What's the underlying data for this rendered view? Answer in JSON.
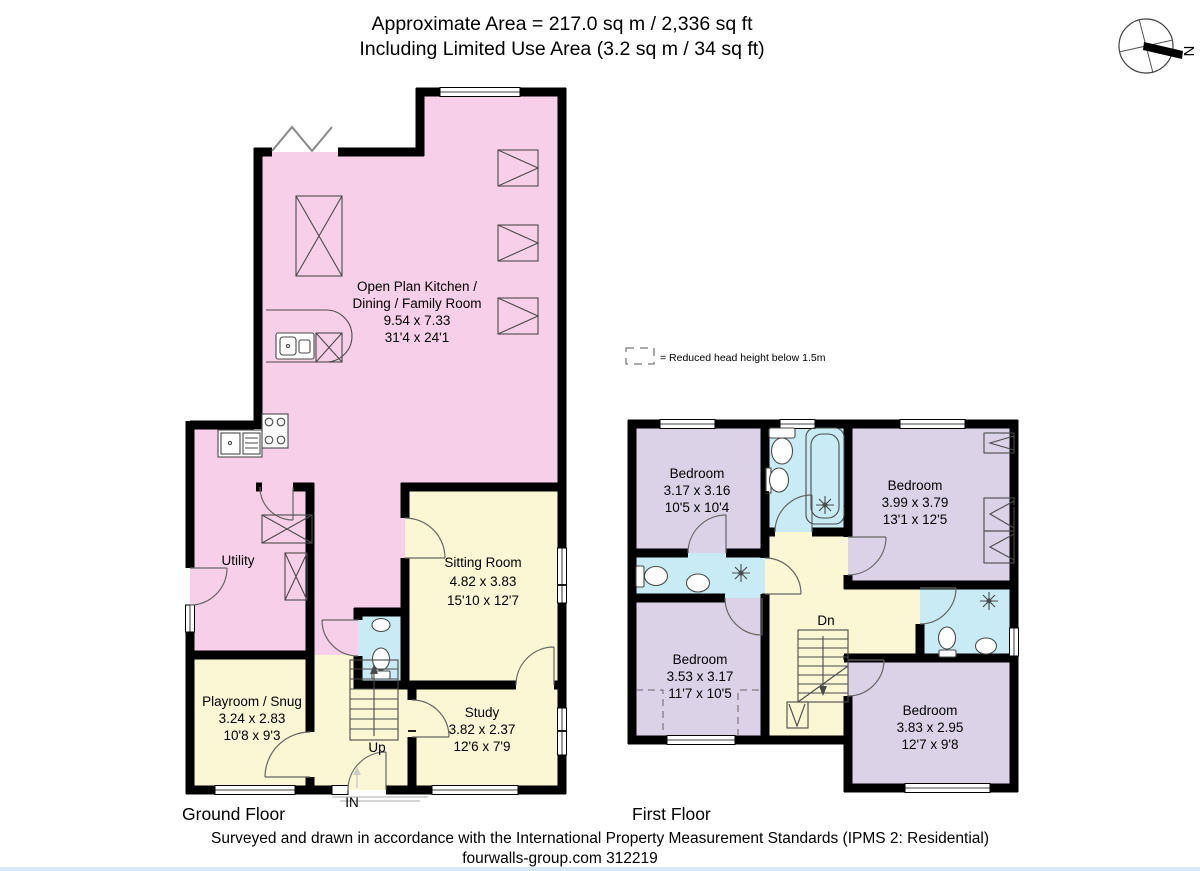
{
  "header": {
    "line1": "Approximate Area = 217.0 sq m / 2,336 sq ft",
    "line2": "Including Limited Use Area (3.2 sq m / 34 sq ft)"
  },
  "compass": {
    "label": "N"
  },
  "legend": {
    "label": "= Reduced head height below 1.5m"
  },
  "ground": {
    "title": "Ground Floor",
    "stairs_label": "Up",
    "entrance_label": "IN",
    "rooms": {
      "kitchen": {
        "line1": "Open Plan Kitchen /",
        "line2": "Dining / Family Room",
        "metric": "9.54 x 7.33",
        "imperial": "31'4 x 24'1"
      },
      "utility": {
        "name": "Utility"
      },
      "sitting": {
        "name": "Sitting Room",
        "metric": "4.82 x 3.83",
        "imperial": "15'10 x 12'7"
      },
      "playroom": {
        "name": "Playroom / Snug",
        "metric": "3.24 x 2.83",
        "imperial": "10'8 x 9'3"
      },
      "study": {
        "name": "Study",
        "metric": "3.82 x 2.37",
        "imperial": "12'6 x 7'9"
      }
    }
  },
  "first": {
    "title": "First Floor",
    "stairs_label": "Dn",
    "rooms": {
      "bedroom1": {
        "name": "Bedroom",
        "metric": "3.17 x 3.16",
        "imperial": "10'5 x 10'4"
      },
      "bedroom2": {
        "name": "Bedroom",
        "metric": "3.99 x 3.79",
        "imperial": "13'1 x 12'5"
      },
      "bedroom3": {
        "name": "Bedroom",
        "metric": "3.53 x 3.17",
        "imperial": "11'7 x 10'5"
      },
      "bedroom4": {
        "name": "Bedroom",
        "metric": "3.83 x 2.95",
        "imperial": "12'7 x 9'8"
      }
    }
  },
  "footer": {
    "line1": "Surveyed and drawn in accordance with the International Property Measurement Standards (IPMS 2: Residential)",
    "line2": "fourwalls-group.com 312219"
  },
  "colors": {
    "pink": "#f8cfe9",
    "yellow": "#fbf6d3",
    "purple": "#dbd2e8",
    "cyan": "#c8ebf5",
    "wall": "#000000",
    "accent_strip": "#d7e9f8"
  }
}
